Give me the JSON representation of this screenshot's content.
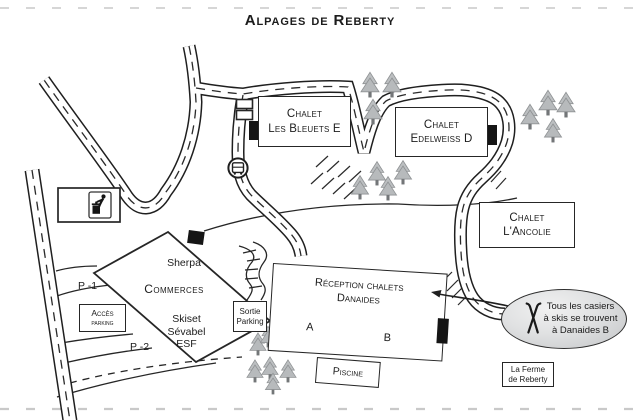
{
  "title": "Alpages de Reberty",
  "map": {
    "chalets": {
      "bleuets": {
        "line1": "Chalet",
        "line2": "Les Bleuets E"
      },
      "edelweiss": {
        "line1": "Chalet",
        "line2": "Edelweiss D"
      },
      "ancolie": {
        "line1": "Chalet",
        "line2": "L'Ancolie"
      },
      "danaides": {
        "line1": "Réception chalets",
        "line2": "Danaides",
        "unit_a": "A",
        "unit_b": "B"
      }
    },
    "facilities": {
      "piscine": "Piscine",
      "ferme_line1": "La Ferme",
      "ferme_line2": "de Reberty",
      "commerces": {
        "title": "Commerces",
        "shop_top": "Sherpa",
        "shop1": "Skiset",
        "shop2": "Sévabel",
        "shop3": "ESF"
      }
    },
    "parking": {
      "acces_line1": "Accès",
      "acces_line2": "parking",
      "sortie_line1": "Sortie",
      "sortie_line2": "Parking",
      "level1": "P -1",
      "level2": "P -2"
    },
    "callout": {
      "line1": "Tous les casiers",
      "line2": "à skis se trouvent",
      "line3": "à Danaides B"
    },
    "icons": {
      "waste_point": "tidyman-trash-icon",
      "shuttle_stop": "bus-stop-icon",
      "ski_lockers": "crossed-skis-icon",
      "vegetation": "pine-tree-icon"
    },
    "colors": {
      "ink": "#1f1f1f",
      "tree": "#b9bcbe",
      "callout_fill": "#d9dadb"
    }
  }
}
